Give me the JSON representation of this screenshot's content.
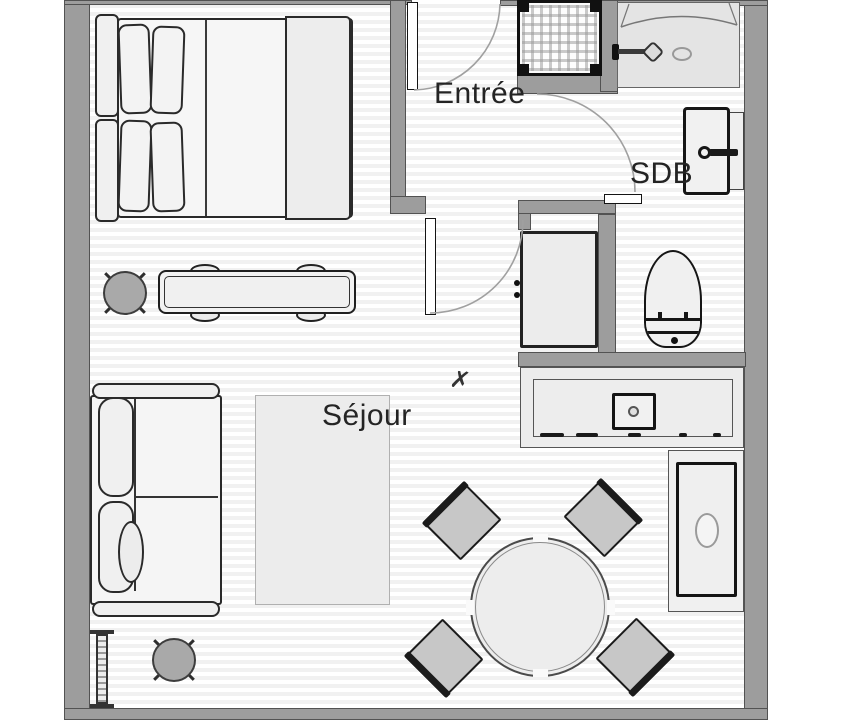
{
  "title_present": false,
  "rooms": {
    "entree": {
      "label": "Entrée"
    },
    "sdb": {
      "label": "SDB"
    },
    "sejour": {
      "label": "Séjour"
    }
  },
  "annotations": {
    "cross_mark": "✗"
  },
  "furniture_icons": [
    "double-bed-icon",
    "pillow-icon",
    "desk-icon",
    "desk-chair-icon",
    "stool-icon",
    "sofa-icon",
    "rug-icon",
    "radiator-icon",
    "round-dining-table-icon",
    "dining-chair-icon",
    "kitchen-counter-icon",
    "kitchen-sink-icon",
    "appliance-icon",
    "shower-icon",
    "bathroom-sink-icon",
    "wall-cabinet-icon",
    "toilet-icon",
    "washing-machine-icon",
    "door-swing-icon"
  ],
  "colors": {
    "wall": "#9d9d9d",
    "wall_outline": "#525252",
    "floor_stripe": "#f1f1f1",
    "furniture_outline": "#1f1f1f",
    "furniture_fill": "#f2f2f2",
    "dining_chair_fill": "#c7c7c7",
    "stool_fill": "#a9a9a9",
    "door_arc": "#a0a0a0",
    "label_text": "#242424"
  }
}
